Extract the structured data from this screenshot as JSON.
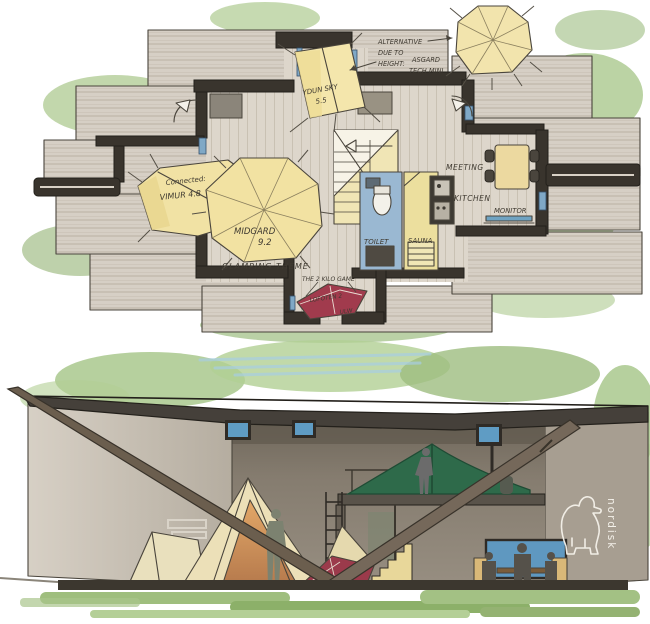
{
  "plan": {
    "note": {
      "line1": "ALTERNATIVE",
      "line2": "DUE TO",
      "line3": "HEIGHT:",
      "alt1": "ASGARD",
      "alt2": "TECH MINI"
    },
    "tents": {
      "ydun_name": "YDUN SKY",
      "ydun_size": "5.5",
      "vimur_note": "Connected:",
      "vimur_name": "VIMUR 4.8",
      "midgard_name": "MIDGARD",
      "midgard_size": "9.2",
      "lofoten_name": "LOFOTEN 2",
      "lofoten_variant": "ULW",
      "lofoten_callout": "THE 2 KILO GAME"
    },
    "rooms": {
      "meeting": "MEETING",
      "kitchen": "KITCHEN",
      "monitor": "MONITOR",
      "toilet": "TOILET",
      "sauna": "SAUNA"
    },
    "theme_label": "GLAMPING THEME"
  },
  "section": {
    "brand": "nordisk"
  },
  "colors": {
    "tent_yellow": "#f2e3a6",
    "tent_red": "#9e3a4b",
    "tarp_green": "#2e6a4a",
    "wall_dark": "#39342d",
    "deck": "#d6cfc5",
    "floor": "#ddd6cb",
    "glass_blue": "#7fa8c6",
    "foliage_green": "#a9c78c",
    "section_wall": "#8e8679",
    "ink": "#3f3a31"
  }
}
